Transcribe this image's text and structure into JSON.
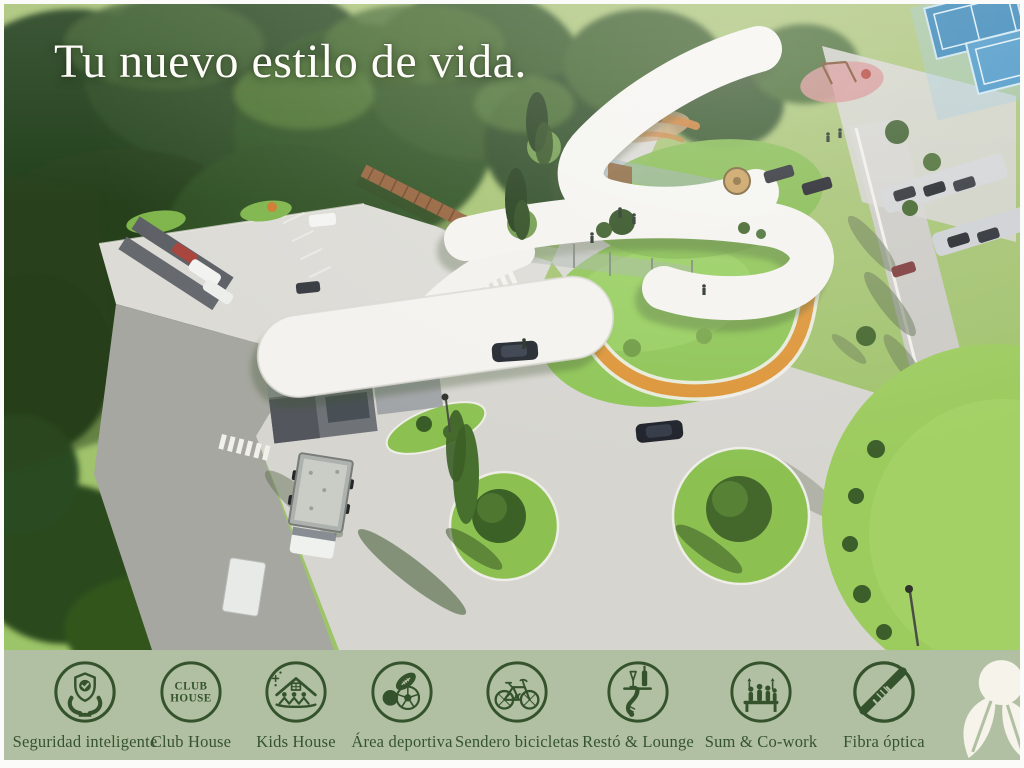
{
  "headline": "Tu nuevo estilo de vida.",
  "scene": {
    "description": "Aerial 3D render of a residential club house complex: curved white canopy buildings, orange jogging track and slide, playground, parking areas with cars and a gravel truck, round lawn planters with trees, tennis courts and dense woods"
  },
  "amenities": [
    {
      "icon": "security-shield-hands-icon",
      "label": "Seguridad inteligente"
    },
    {
      "icon": "club-house-badge-icon",
      "label": "Club House",
      "badge_line1": "CLUB",
      "badge_line2": "HOUSE"
    },
    {
      "icon": "kids-house-icon",
      "label": "Kids House"
    },
    {
      "icon": "sports-balls-icon",
      "label": "Área deportiva"
    },
    {
      "icon": "bicycle-icon",
      "label": "Sendero bicicletas"
    },
    {
      "icon": "waiter-tray-icon",
      "label": "Restó & Lounge"
    },
    {
      "icon": "cowork-people-icon",
      "label": "Sum & Co-work"
    },
    {
      "icon": "fiber-optic-cable-icon",
      "label": "Fibra óptica"
    }
  ],
  "logo": {
    "name": "plant-leaf-logo"
  },
  "palette": {
    "bar_background": "#b1c0a3",
    "icon_green": "#34522c",
    "headline_white": "#fdfcf8",
    "track_orange": "#dd9538",
    "lawn_green": "#8ec556",
    "road_gray": "#d6d5d0",
    "court_blue": "#2f80b4"
  }
}
